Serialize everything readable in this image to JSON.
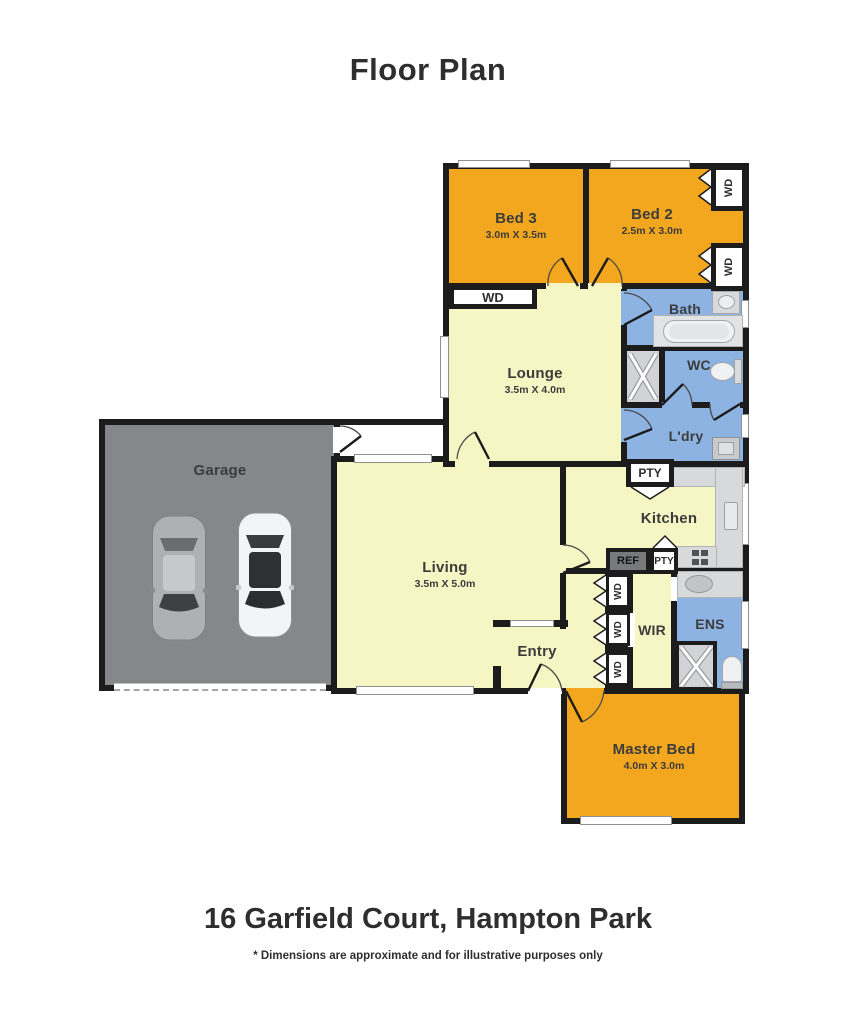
{
  "title": "Floor Plan",
  "address": "16 Garfield Court, Hampton Park",
  "disclaimer": "* Dimensions are approximate and for illustrative purposes only",
  "colors": {
    "bedroom": "#F2A71E",
    "wet_area": "#8DB3E2",
    "living_area": "#F6F5C4",
    "garage": "#85878B",
    "wall": "#1C1C1C",
    "counter": "#D8D9DB"
  },
  "rooms": {
    "bed3": {
      "name": "Bed 3",
      "dims": "3.0m X 3.5m"
    },
    "bed2": {
      "name": "Bed 2",
      "dims": "2.5m X 3.0m"
    },
    "lounge": {
      "name": "Lounge",
      "dims": "3.5m X 4.0m"
    },
    "living": {
      "name": "Living",
      "dims": "3.5m X 5.0m"
    },
    "master": {
      "name": "Master Bed",
      "dims": "4.0m X 3.0m"
    },
    "garage": {
      "name": "Garage"
    },
    "bath": {
      "name": "Bath"
    },
    "wc": {
      "name": "WC"
    },
    "ldry": {
      "name": "L'dry"
    },
    "kitchen": {
      "name": "Kitchen"
    },
    "entry": {
      "name": "Entry"
    },
    "wir": {
      "name": "WIR"
    },
    "ens": {
      "name": "ENS"
    }
  },
  "labels": {
    "wd": "WD",
    "pty": "PTY",
    "ref": "REF"
  }
}
